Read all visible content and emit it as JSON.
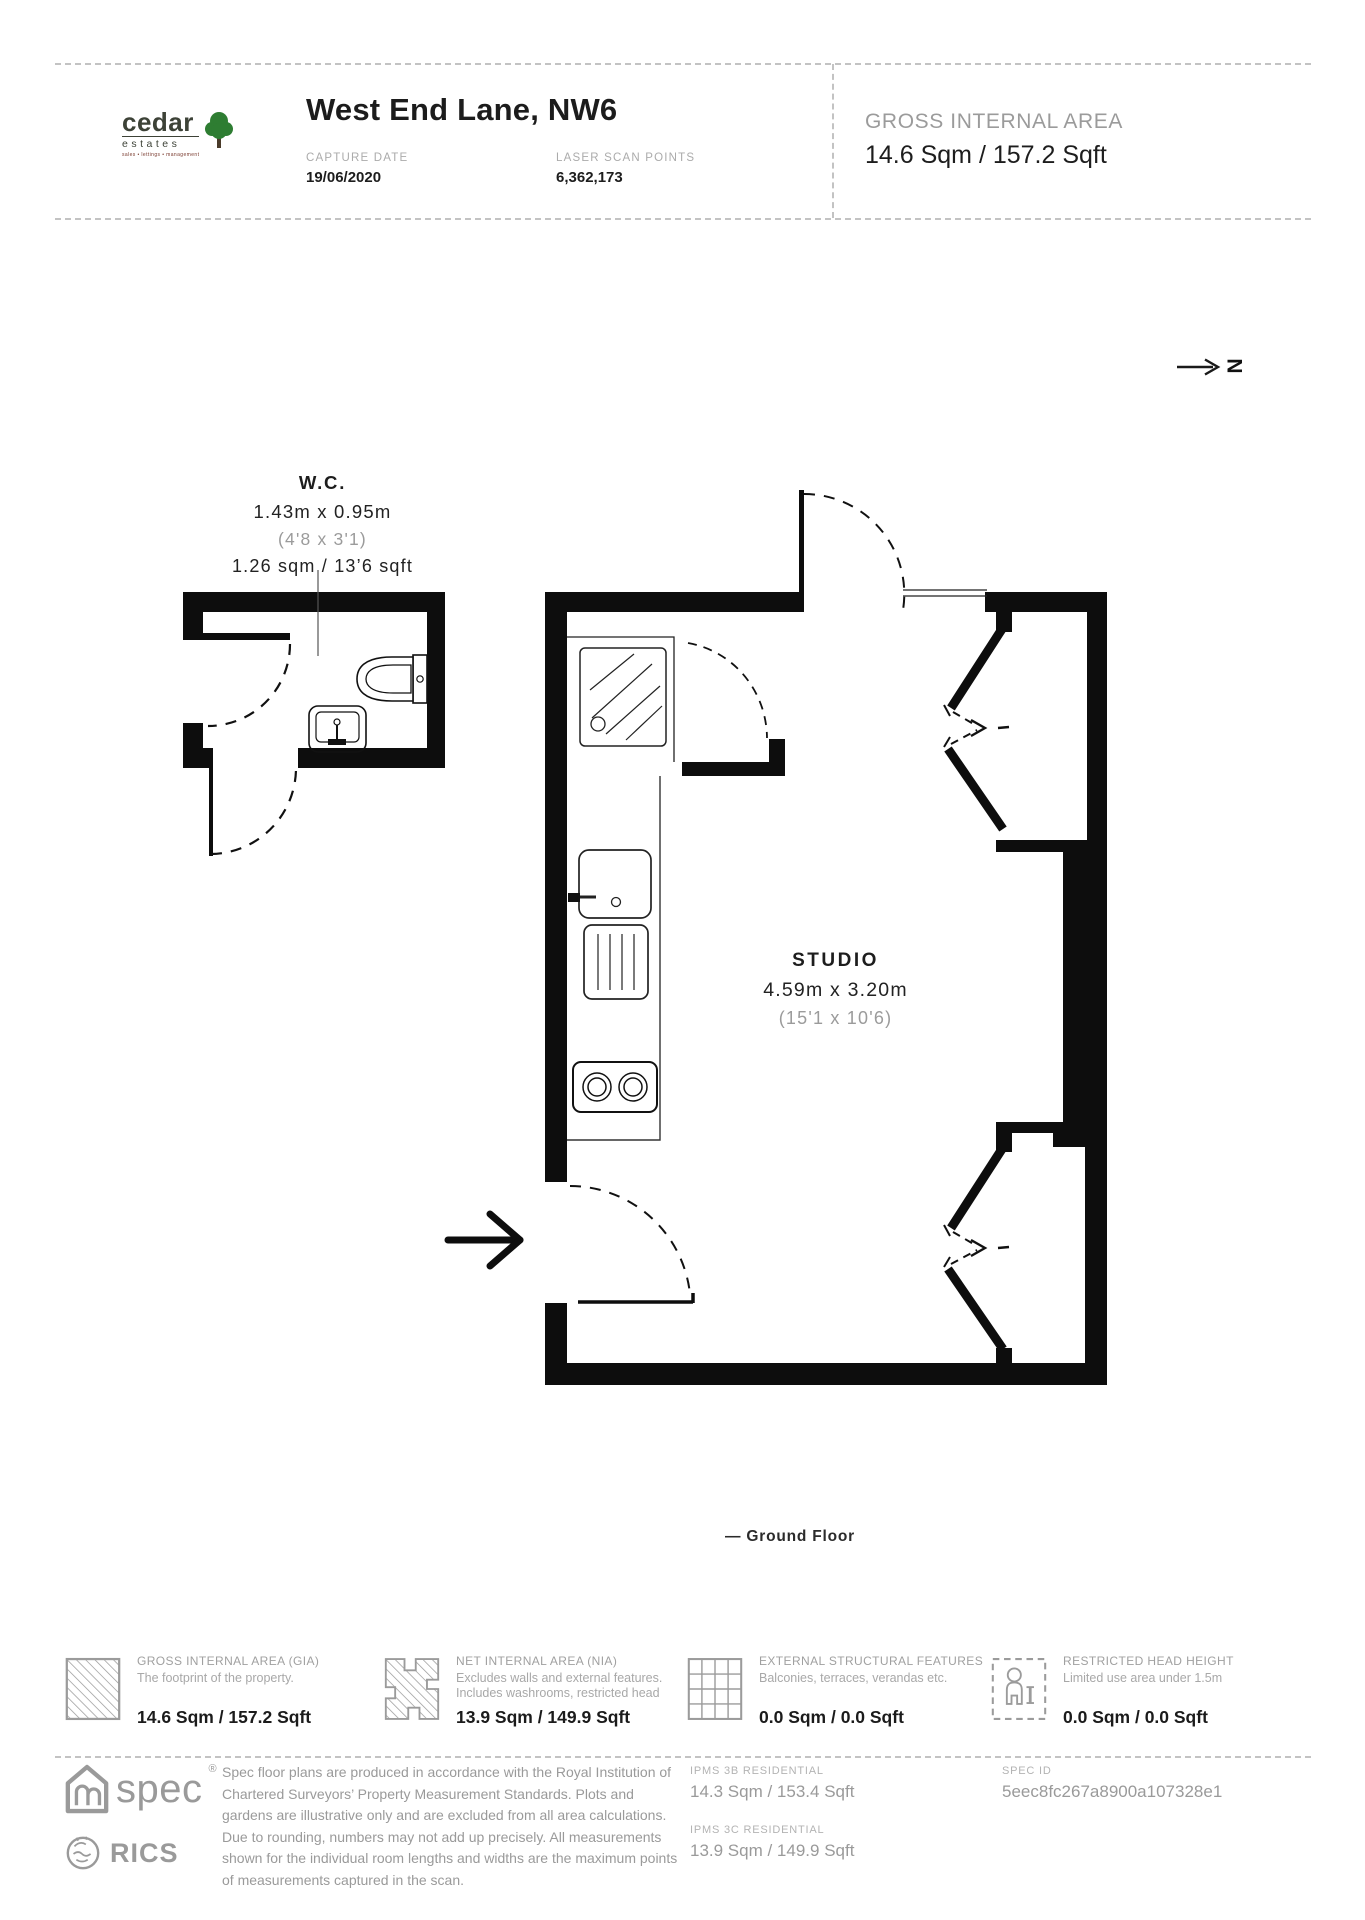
{
  "header": {
    "logo": {
      "brand": "cedar",
      "brand2": "estates",
      "tagline": "sales • lettings • management"
    },
    "title": "West End Lane, NW6",
    "capture_date_label": "CAPTURE DATE",
    "capture_date_value": "19/06/2020",
    "laser_scan_label": "LASER SCAN POINTS",
    "laser_scan_value": "6,362,173",
    "gia_label": "GROSS INTERNAL AREA",
    "gia_value": "14.6 Sqm / 157.2 Sqft"
  },
  "north_label": "N",
  "plan": {
    "wc": {
      "name": "W.C.",
      "dim_metric": "1.43m x 0.95m",
      "dim_imperial": "(4'8 x 3'1)",
      "area": "1.26 sqm / 13’6 sqft"
    },
    "studio": {
      "name": "STUDIO",
      "dim_metric": "4.59m x 3.20m",
      "dim_imperial": "(15'1 x 10'6)"
    },
    "floor_caption": "— Ground Floor"
  },
  "legend": [
    {
      "title": "GROSS INTERNAL AREA (GIA)",
      "desc1": "The footprint of the property.",
      "desc2": "",
      "value": "14.6 Sqm / 157.2 Sqft"
    },
    {
      "title": "NET INTERNAL AREA (NIA)",
      "desc1": "Excludes walls and external features.",
      "desc2": "Includes washrooms, restricted head",
      "value": "13.9 Sqm / 149.9 Sqft"
    },
    {
      "title": "EXTERNAL STRUCTURAL FEATURES",
      "desc1": "Balconies, terraces, verandas etc.",
      "desc2": "",
      "value": "0.0 Sqm / 0.0 Sqft"
    },
    {
      "title": "RESTRICTED HEAD HEIGHT",
      "desc1": "Limited use area under 1.5m",
      "desc2": "",
      "value": "0.0 Sqm / 0.0 Sqft"
    }
  ],
  "footer": {
    "spec_brand": "spec",
    "rics_brand": "RICS",
    "disclaimer": "Spec floor plans are produced in accordance with the Royal Institution of Chartered Surveyors’ Property Measurement Standards. Plots and gardens are illustrative only and are excluded from all area calculations. Due to rounding, numbers may not add up precisely. All measurements shown for the individual room lengths and widths are the maximum points of measurements captured in the scan.",
    "ipms": [
      {
        "label": "IPMS 3B RESIDENTIAL",
        "value": "14.3 Sqm / 153.4 Sqft"
      },
      {
        "label": "IPMS 3C RESIDENTIAL",
        "value": "13.9 Sqm / 149.9 Sqft"
      }
    ],
    "spec_id_label": "SPEC ID",
    "spec_id_value": "5eec8fc267a8900a107328e1"
  },
  "colors": {
    "wall": "#0d0d0d",
    "gray_label": "#9b9b9b",
    "text_dark": "#1d1d1d",
    "logo_green": "#2e7d32",
    "dash": "#c3c3c3"
  }
}
